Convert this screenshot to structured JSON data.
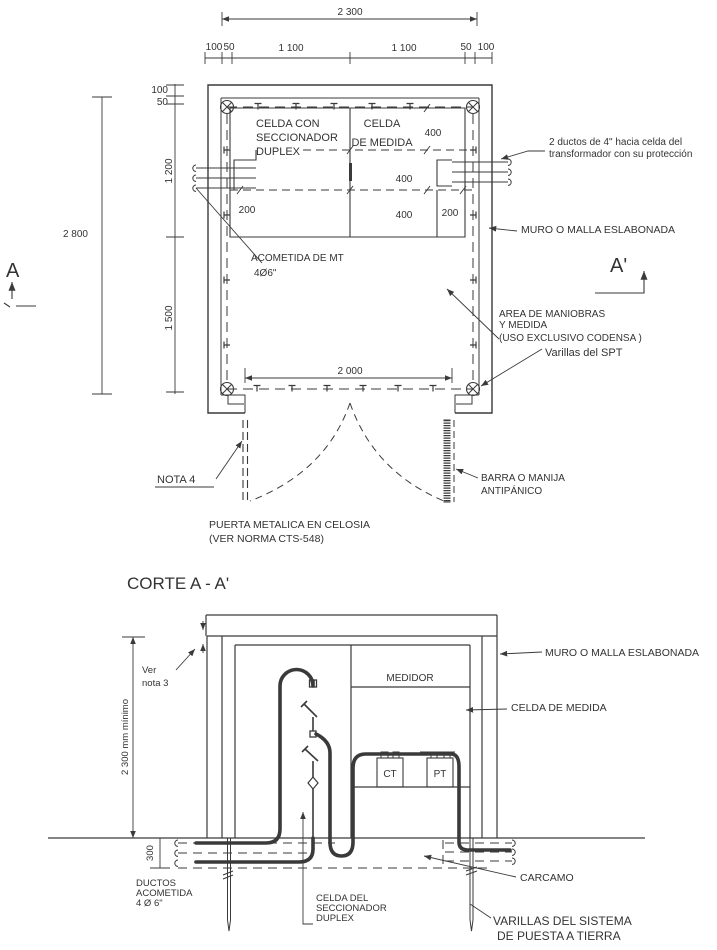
{
  "meta": {
    "ink_color": "#3a3a3a",
    "background": "#ffffff",
    "drawing_type": "electrical substation room standard drawing"
  },
  "plan": {
    "dim_total_width": "2 300",
    "dim_chain_top": [
      "100",
      "50",
      "1 100",
      "1 100",
      "50",
      "100"
    ],
    "dim_left": {
      "d100": "100",
      "d50": "50",
      "d1200": "1 200",
      "d1500": "1 500",
      "d2800": "2 800"
    },
    "dim_interior": {
      "d400a": "400",
      "d400b": "400",
      "d400c": "400",
      "d200l": "200",
      "d200r": "200",
      "d2000": "2 000"
    },
    "cell_seccionador": [
      "CELDA CON",
      "SECCIONADOR",
      "DUPLEX"
    ],
    "cell_medida": [
      "CELDA",
      "DE MEDIDA"
    ],
    "acometida": [
      "ACOMETIDA DE MT",
      "4Ø6\""
    ],
    "ductos_transformador": [
      "2 ductos de 4\" hacia celda del",
      "transformador con su protección"
    ],
    "muro": "MURO O MALLA ESLABONADA",
    "area": [
      "AREA DE MANIOBRAS",
      "Y MEDIDA",
      "(USO EXCLUSIVO CODENSA )"
    ],
    "varillas_spt": "Varillas del SPT",
    "nota4": "NOTA 4",
    "puerta": [
      "PUERTA METALICA EN CELOSIA",
      "(VER NORMA CTS-548)"
    ],
    "barra": [
      "BARRA O MANIJA",
      "ANTIPÁNICO"
    ],
    "marker_a": "A",
    "marker_a_prime": "A'"
  },
  "section": {
    "title": "CORTE A - A'",
    "muro": "MURO O MALLA ESLABONADA",
    "celda_medida": "CELDA DE MEDIDA",
    "medidor": "MEDIDOR",
    "ct": "CT",
    "pt": "PT",
    "ver_nota": [
      "Ver",
      "nota 3"
    ],
    "dim_height": "2 300 mm mínimo",
    "dim_depth": "300",
    "ductos": [
      "DUCTOS",
      "ACOMETIDA",
      "4 Ø 6\""
    ],
    "celda_seccionador": [
      "CELDA DEL",
      "SECCIONADOR",
      "DUPLEX"
    ],
    "carcamo": "CARCAMO",
    "varillas": [
      "VARILLAS DEL SISTEMA",
      "DE PUESTA A TIERRA"
    ]
  }
}
